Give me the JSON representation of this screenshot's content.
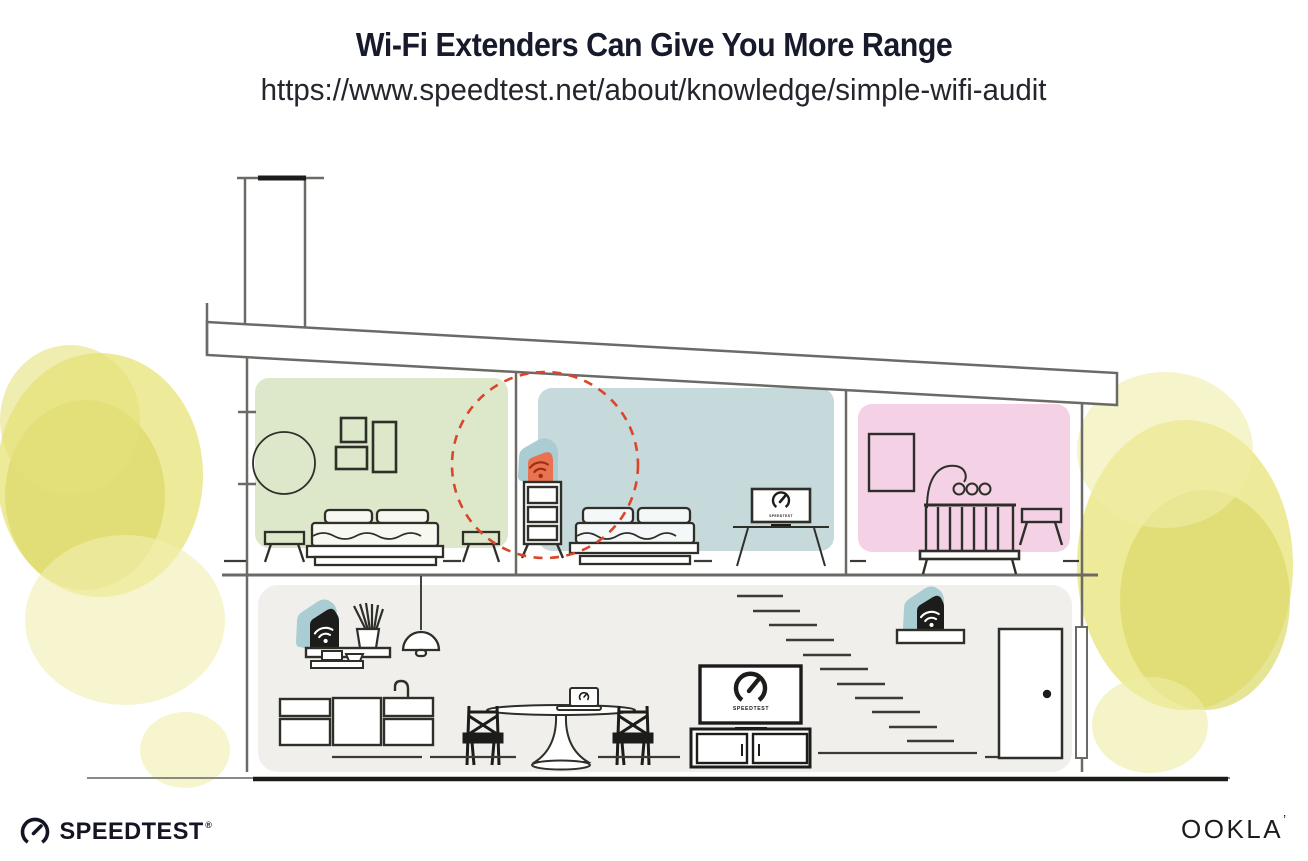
{
  "header": {
    "title": "Wi-Fi Extenders Can Give You More Range",
    "url": "https://www.speedtest.net/about/knowledge/simple-wifi-audit"
  },
  "illustration": {
    "tv_label": "SPEEDTEST",
    "icons": {
      "extender_device": "wifi-icon",
      "tv_screen": "speedtest-gauge-icon",
      "highlighted_extender": "wifi-icon-orange",
      "range_indicator": "dashed-circle"
    },
    "colors": {
      "room_green": "#dde8ca",
      "room_blue": "#c6d9db",
      "room_pink": "#f4d1e5",
      "room_gray": "#f0efec",
      "device_teal": "#a9cdd3",
      "highlight_orange": "#e97350",
      "range_red": "#d9472b",
      "foliage_yellow": "#e4e17b",
      "line_gray": "#6b6a66",
      "ink": "#1c1c1a"
    }
  },
  "footer": {
    "speedtest_label": "SPEEDTEST",
    "speedtest_mark": "®",
    "ookla_label": "OOKLA",
    "ookla_mark": "’"
  }
}
